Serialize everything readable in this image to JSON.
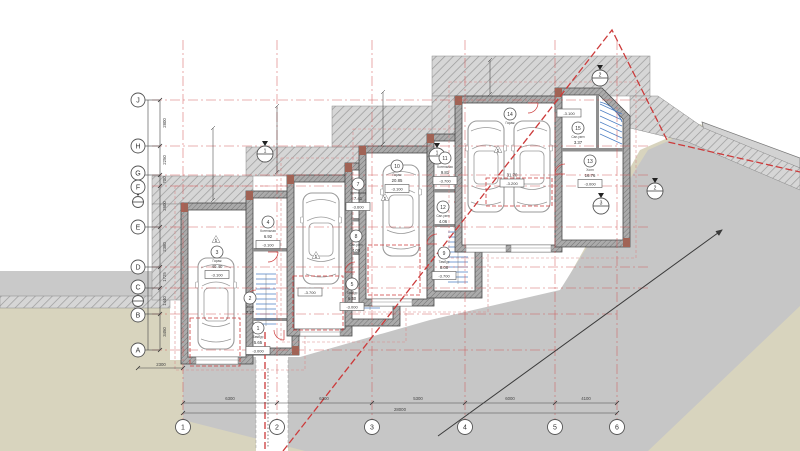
{
  "drawing": {
    "type": "architectural-site-floor-plan",
    "description": "Terraced houses stepping along a sloped site with garages, cars, stairs and a diagonal access road"
  },
  "grid": {
    "rows": [
      "J",
      "H",
      "G",
      "F",
      "E",
      "D",
      "C",
      "B",
      "A"
    ],
    "row_dims": [
      "2800",
      "2250",
      "700",
      "2600",
      "2380",
      "1725",
      "1440",
      "3450"
    ],
    "cols": [
      "1",
      "2",
      "3",
      "4",
      "5",
      "6"
    ],
    "col_dims": [
      "6300",
      "6300",
      "5300",
      "6000",
      "4100"
    ],
    "col_total": "28000",
    "offset_dim": "2300"
  },
  "rooms": {
    "h1r3": {
      "num": "3",
      "name": "Гараж",
      "area": "40.40",
      "level": "-3.100"
    },
    "h1r4": {
      "num": "4",
      "name": "Котельная",
      "area": "6.92",
      "level": "-3.100"
    },
    "h1r2": {
      "num": "2",
      "name": "Холл",
      "area": "7.27"
    },
    "h1r1": {
      "num": "1",
      "name": "Тамбур",
      "area": "5.65",
      "level": "-3.000"
    },
    "h2r7": {
      "num": "7",
      "name": "Котельная",
      "area": "7.41",
      "level": "-3.600"
    },
    "h2r8": {
      "num": "8",
      "name": "Сан.узел",
      "area": "4.00"
    },
    "h2r5": {
      "num": "5",
      "name": "Тамбур",
      "area": "6.40",
      "level": "-3.000"
    },
    "h3r10": {
      "num": "10",
      "name": "Гараж",
      "area": "20.85",
      "level": "-3.100"
    },
    "h3r11": {
      "num": "11",
      "name": "Котельная",
      "area": "9.81",
      "level": "-3.700"
    },
    "h3r12": {
      "num": "12",
      "name": "Сан.узел",
      "area": "4.06"
    },
    "h3r9": {
      "num": "9",
      "name": "Тамбур",
      "area": "8.08",
      "level": "-3.700"
    },
    "h4r14": {
      "num": "14",
      "name": "Гараж",
      "area": "31.70",
      "level": "-3.200"
    },
    "h4r15": {
      "num": "15",
      "name": "Сан.узел",
      "area": "3.37"
    },
    "h4r13": {
      "num": "13",
      "name": "Холл",
      "area": "16.76",
      "level": "-3.000"
    }
  },
  "levels": {
    "h4_top": "-3.100",
    "h2_parking": "-3.700"
  },
  "markers": [
    {
      "num": "1"
    },
    {
      "num": "1"
    },
    {
      "num": "2"
    },
    {
      "num": "2"
    },
    {
      "num": "3"
    }
  ],
  "door_mark": "1",
  "colors": {
    "boundary": "#cc3b3b",
    "grid_line": "#d05555",
    "stairs": "#4d7fc4",
    "ground": "#d8d4be",
    "road": "#c6c6c6"
  }
}
